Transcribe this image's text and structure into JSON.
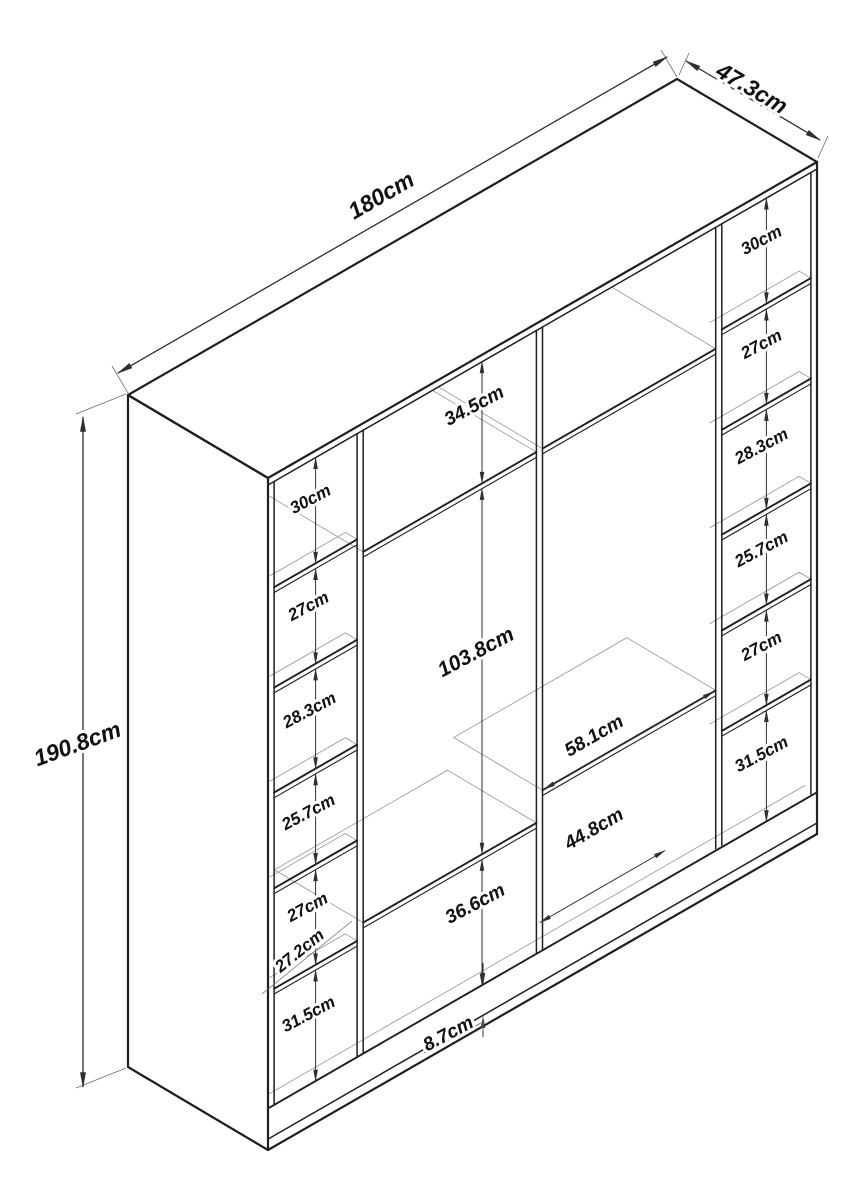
{
  "overall": {
    "width_label": "180cm",
    "depth_label": "47.3cm",
    "height_label": "190.8cm"
  },
  "left_column": {
    "compartment_heights": [
      "30cm",
      "27cm",
      "28.3cm",
      "25.7cm",
      "27cm",
      "31.5cm"
    ],
    "column_width_label": "27.2cm"
  },
  "right_column": {
    "compartment_heights": [
      "30cm",
      "27cm",
      "28.3cm",
      "25.7cm",
      "27cm",
      "31.5cm"
    ]
  },
  "middle_section": {
    "top_compartment_height": "34.5cm",
    "hanging_space_height": "103.8cm",
    "shelf_width_label": "58.1cm",
    "bottom_width_label": "44.8cm",
    "bottom_compartment_height": "36.6cm",
    "base_height_label": "8.7cm"
  },
  "colors": {
    "outline": "#1f1f1f",
    "hint": "#9f9f9f",
    "dimension": "#2f2f2f",
    "background": "#ffffff"
  }
}
